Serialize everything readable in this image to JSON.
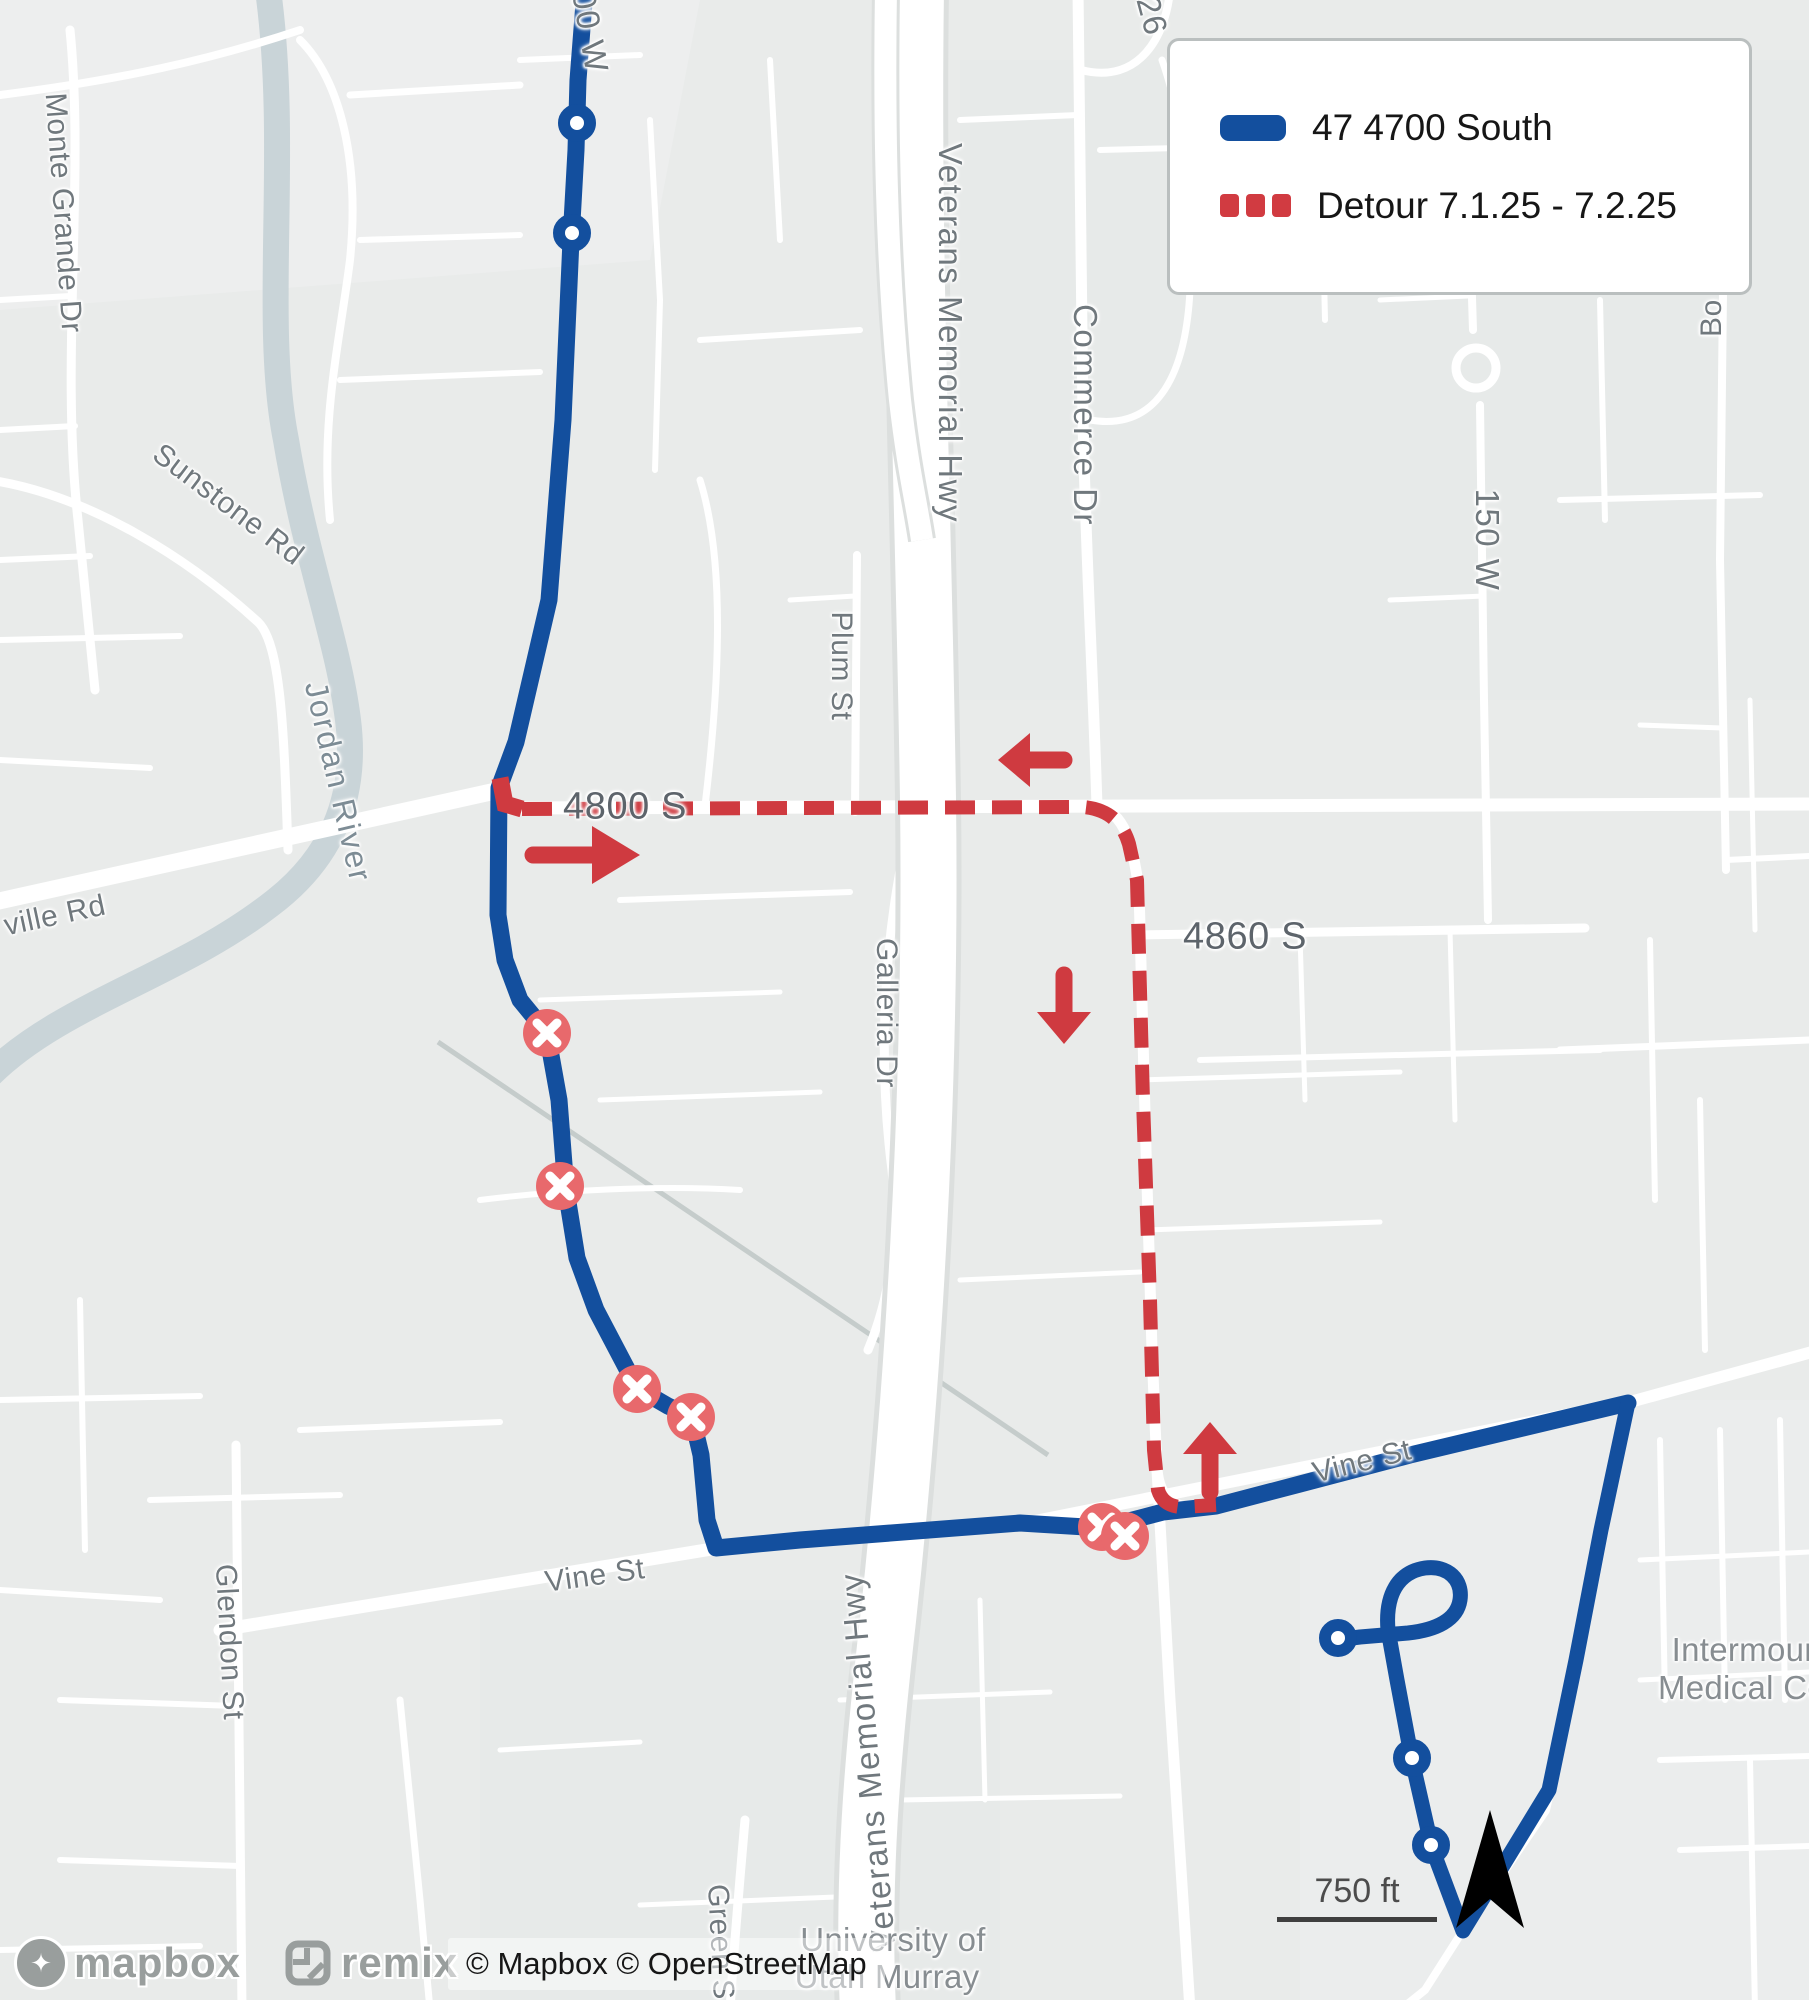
{
  "legend": {
    "route_label": "47 4700 South",
    "detour_label": "Detour 7.1.25 - 7.2.25"
  },
  "colors": {
    "route_blue": "#134f9e",
    "detour_red": "#cf3a40",
    "closed_stop_pink": "#e8696c",
    "map_background": "#e9ebea",
    "road_white": "#ffffff",
    "river_blue_gray": "#c9d4d8",
    "label_gray": "#70787d"
  },
  "scale_bar": {
    "label": "750 ft"
  },
  "attribution": {
    "text": "© Mapbox © OpenStreetMap"
  },
  "logos": {
    "mapbox": "mapbox",
    "remix": "remix",
    "mapbox_pin_glyph": "✦"
  },
  "map_labels": [
    {
      "text": "00 W",
      "x": 590,
      "y": 32,
      "rot": 80,
      "cls": "hwy"
    },
    {
      "text": "Monte Grande Dr",
      "x": 63,
      "y": 213,
      "rot": 86,
      "cls": ""
    },
    {
      "text": "Sunstone Rd",
      "x": 228,
      "y": 505,
      "rot": 37,
      "cls": ""
    },
    {
      "text": "Jordan River",
      "x": 338,
      "y": 782,
      "rot": 77,
      "cls": "water"
    },
    {
      "text": "ville Rd",
      "x": 55,
      "y": 916,
      "rot": -12,
      "cls": ""
    },
    {
      "text": "Glendon St",
      "x": 229,
      "y": 1642,
      "rot": 87,
      "cls": ""
    },
    {
      "text": "Vine St",
      "x": 595,
      "y": 1576,
      "rot": -8,
      "cls": ""
    },
    {
      "text": "Vine St",
      "x": 1362,
      "y": 1462,
      "rot": -14,
      "cls": ""
    },
    {
      "text": "Green S",
      "x": 720,
      "y": 1942,
      "rot": 87,
      "cls": ""
    },
    {
      "text": "Plum St",
      "x": 841,
      "y": 666,
      "rot": 90,
      "cls": ""
    },
    {
      "text": "Galleria Dr",
      "x": 886,
      "y": 1013,
      "rot": 90,
      "cls": ""
    },
    {
      "text": "Veterans Memorial Hwy",
      "x": 950,
      "y": 333,
      "rot": 90,
      "cls": "hwy"
    },
    {
      "text": "Veterans Memorial Hwy",
      "x": 868,
      "y": 1762,
      "rot": -95,
      "cls": "hwy"
    },
    {
      "text": "Commerce Dr",
      "x": 1085,
      "y": 415,
      "rot": 90,
      "cls": "hwy"
    },
    {
      "text": "26",
      "x": 1152,
      "y": 16,
      "rot": 75,
      "cls": "hwy"
    },
    {
      "text": "150 W",
      "x": 1487,
      "y": 540,
      "rot": 90,
      "cls": "hwy"
    },
    {
      "text": "Bo",
      "x": 1712,
      "y": 318,
      "rot": -90,
      "cls": ""
    },
    {
      "text": "4800 S",
      "x": 625,
      "y": 807,
      "rot": 0,
      "cls": "shield"
    },
    {
      "text": "4860 S",
      "x": 1245,
      "y": 937,
      "rot": 0,
      "cls": "shield"
    },
    {
      "text": "University of",
      "x": 893,
      "y": 1940,
      "rot": 0,
      "cls": "place"
    },
    {
      "text": "Utah Murray",
      "x": 887,
      "y": 1977,
      "rot": 0,
      "cls": "place"
    },
    {
      "text": "Intermount",
      "x": 1752,
      "y": 1650,
      "rot": 0,
      "cls": "place"
    },
    {
      "text": "Medical Ce",
      "x": 1742,
      "y": 1688,
      "rot": 0,
      "cls": "place"
    }
  ]
}
